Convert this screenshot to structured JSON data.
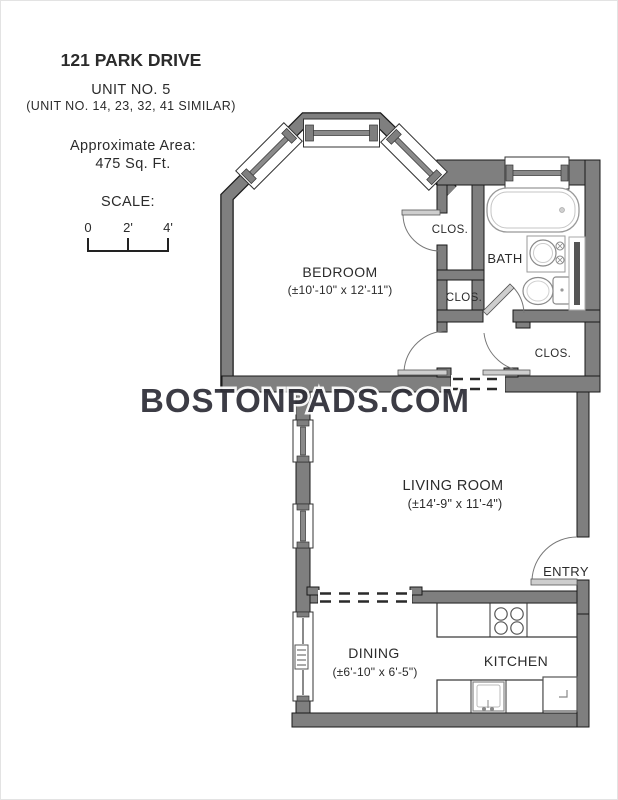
{
  "header": {
    "address": "121 PARK DRIVE",
    "unit": "UNIT NO. 5",
    "similar_units": "(UNIT NO. 14, 23, 32, 41 SIMILAR)",
    "area_label": "Approximate Area:",
    "area_value": "475 Sq. Ft.",
    "scale_label": "SCALE:",
    "scale_ticks": [
      "0",
      "2'",
      "4'"
    ]
  },
  "watermark": "BOSTONPADS.COM",
  "rooms": {
    "bedroom": {
      "name": "BEDROOM",
      "dims": "(±10'-10\" x 12'-11\")"
    },
    "bath": {
      "name": "BATH"
    },
    "living": {
      "name": "LIVING ROOM",
      "dims": "(±14'-9\" x 11'-4\")"
    },
    "dining": {
      "name": "DINING",
      "dims": "(±6'-10\" x 6'-5\")"
    },
    "kitchen": {
      "name": "KITCHEN"
    },
    "entry": {
      "name": "ENTRY"
    },
    "closet1": {
      "name": "CLOS."
    },
    "closet2": {
      "name": "CLOS."
    },
    "closet3": {
      "name": "CLOS."
    }
  },
  "colors": {
    "wall": "#7f7f7f",
    "wall_outline": "#1a1a1a",
    "watermark": "#2e2e38",
    "fixture_outline": "#999999"
  }
}
